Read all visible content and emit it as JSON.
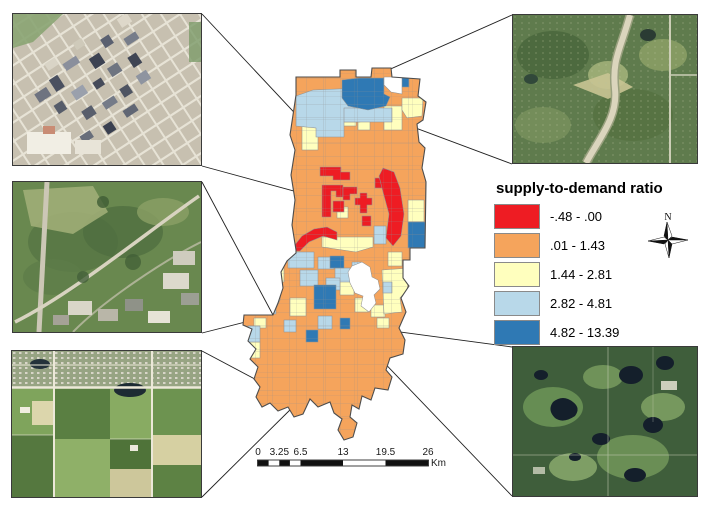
{
  "figure": {
    "type": "choropleth map with aerial-photo insets",
    "background": "#ffffff"
  },
  "legend": {
    "title": "supply-to-demand ratio",
    "classes": [
      {
        "label": "-.48 - .00",
        "color": "#ee1c23"
      },
      {
        "label": ".01 - 1.43",
        "color": "#f5a45c"
      },
      {
        "label": "1.44 - 2.81",
        "color": "#ffffbe"
      },
      {
        "label": "2.82 - 4.81",
        "color": "#b8d8e9"
      },
      {
        "label": "4.82 - 13.39",
        "color": "#2f79b4"
      }
    ]
  },
  "north_arrow": {
    "label": "N"
  },
  "scalebar": {
    "labels": [
      "0",
      "3.25",
      "6.5",
      "13",
      "19.5",
      "26"
    ],
    "unit": "Km"
  },
  "map": {
    "no_data_color": "#ffffff",
    "boundary_color": "#4d4d4d",
    "tract_line_color": "#929292",
    "leader_line_color": "#1f1f1f"
  },
  "insets": [
    {
      "position": "top-left",
      "name": "downtown-urban-aerial"
    },
    {
      "position": "middle-left",
      "name": "park-greenspace-aerial"
    },
    {
      "position": "bottom-left",
      "name": "farmland-suburb-aerial"
    },
    {
      "position": "top-right",
      "name": "suburban-highway-aerial"
    },
    {
      "position": "bottom-right",
      "name": "rural-lakes-aerial"
    }
  ]
}
